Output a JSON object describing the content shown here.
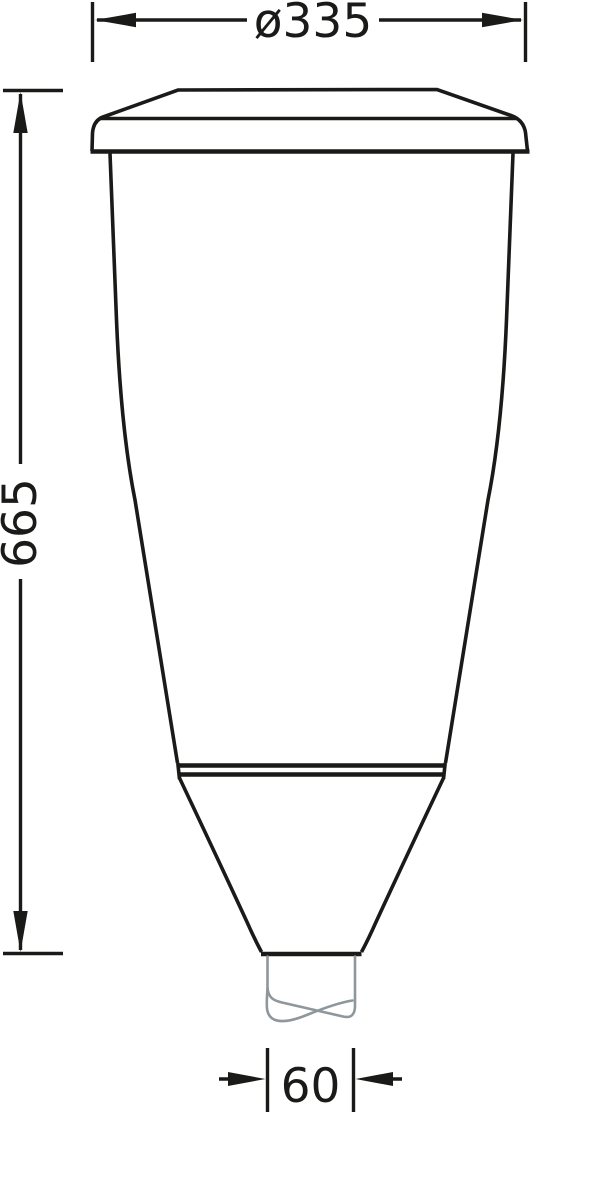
{
  "drawing": {
    "kind": "technical-dimension-drawing",
    "dimensions": {
      "diameter": "ø335",
      "height": "665",
      "outlet_width": "60"
    },
    "colors": {
      "line": "#1a1a18",
      "break_line": "#8e979b",
      "background": "#ffffff"
    }
  }
}
